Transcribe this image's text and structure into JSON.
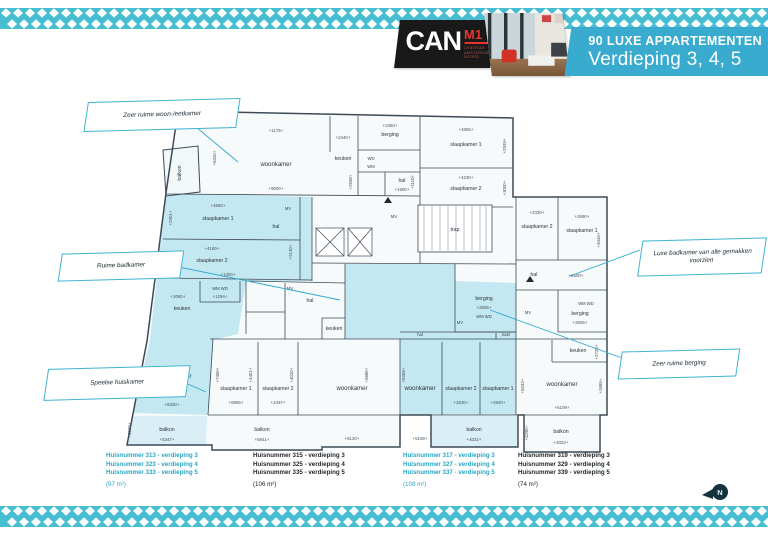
{
  "colors": {
    "teal": "#39abce",
    "pattern": "#47bdd2",
    "logo_red": "#e8352b",
    "plan_blue": "#c3e8f2",
    "balkon_blue": "#daeef6",
    "wall": "#3d4a56"
  },
  "header": {
    "logo": {
      "brand": "CAN",
      "mark": "M1",
      "tagline_lines": [
        "CENTRUM",
        "AMSTERDAM",
        "NOORD"
      ]
    },
    "banner": {
      "title": "90 LUXE APPARTEMENTEN",
      "subtitle": "Verdieping 3, 4, 5"
    }
  },
  "callouts": [
    {
      "text": "Zeer ruime woon-/eetkamer"
    },
    {
      "text": "Ruime badkamer"
    },
    {
      "text": "Speelse huiskamer"
    },
    {
      "text": "Luxe badkamer van alle gemakken voorzien"
    },
    {
      "text": "Zeer ruime berging"
    }
  ],
  "units_legend": [
    {
      "lines": [
        "Huisnummer 313 - verdieping 3",
        "Huisnummer 323 - verdieping 4",
        "Huisnummer 333 - verdieping 5"
      ],
      "area": "(97 m²)",
      "highlight": true
    },
    {
      "lines": [
        "Huisnummer 315 - verdieping 3",
        "Huisnummer 325 - verdieping 4",
        "Huisnummer 335 - verdieping 5"
      ],
      "area": "(106 m²)",
      "highlight": false
    },
    {
      "lines": [
        "Huisnummer 317 - verdieping 3",
        "Huisnummer 327 - verdieping 4",
        "Huisnummer 337 - verdieping 5"
      ],
      "area": "(108 m²)",
      "highlight": true
    },
    {
      "lines": [
        "Huisnummer 319 - verdieping 3",
        "Huisnummer 329 - verdieping 4",
        "Huisnummer 339 - verdieping 5"
      ],
      "area": "(74 m²)",
      "highlight": false
    }
  ],
  "north_badge": {
    "label": "N"
  },
  "floorplan": {
    "labels": [
      {
        "t": "woonkamer",
        "x": 276,
        "y": 166,
        "c": "room"
      },
      {
        "t": "+1175+",
        "x": 276,
        "y": 132,
        "c": "dim"
      },
      {
        "t": "+5320+",
        "x": 216,
        "y": 158,
        "r": -90,
        "c": "dim"
      },
      {
        "t": "+9000+",
        "x": 276,
        "y": 190,
        "c": "dim"
      },
      {
        "t": "keuken",
        "x": 343,
        "y": 160,
        "c": "rsm"
      },
      {
        "t": "+2440+",
        "x": 343,
        "y": 139,
        "c": "dim"
      },
      {
        "t": "berging",
        "x": 390,
        "y": 136,
        "c": "rsm"
      },
      {
        "t": "+2350+",
        "x": 390,
        "y": 127,
        "c": "dim"
      },
      {
        "t": "+2938+",
        "x": 352,
        "y": 182,
        "r": -90,
        "c": "dim"
      },
      {
        "t": "WD",
        "x": 371,
        "y": 160,
        "c": "tiny"
      },
      {
        "t": "WM",
        "x": 371,
        "y": 168,
        "c": "tiny"
      },
      {
        "t": "hal",
        "x": 402,
        "y": 182,
        "c": "rsm"
      },
      {
        "t": "+1900+",
        "x": 402,
        "y": 191,
        "c": "dim"
      },
      {
        "t": "balkon",
        "x": 181,
        "y": 173,
        "r": -90,
        "c": "rsm"
      },
      {
        "t": "slaapkamer 1",
        "x": 466,
        "y": 146,
        "c": "rsm"
      },
      {
        "t": "+4865+",
        "x": 466,
        "y": 131,
        "c": "dim"
      },
      {
        "t": "+2939+",
        "x": 506,
        "y": 146,
        "r": -90,
        "c": "dim"
      },
      {
        "t": "slaapkamer 2",
        "x": 466,
        "y": 190,
        "c": "rsm"
      },
      {
        "t": "+4230+",
        "x": 466,
        "y": 179,
        "c": "dim"
      },
      {
        "t": "+3000+",
        "x": 506,
        "y": 188,
        "r": -90,
        "c": "dim"
      },
      {
        "t": "trap",
        "x": 455,
        "y": 231,
        "c": "rsm"
      },
      {
        "t": "MV",
        "x": 394,
        "y": 218,
        "c": "tiny"
      },
      {
        "t": "+1110+",
        "x": 414,
        "y": 182,
        "r": -90,
        "c": "dim"
      },
      {
        "t": "slaapkamer 2",
        "x": 537,
        "y": 228,
        "c": "rsm"
      },
      {
        "t": "+2330+",
        "x": 537,
        "y": 214,
        "c": "dim"
      },
      {
        "t": "slaapkamer 1",
        "x": 582,
        "y": 232,
        "c": "rsm"
      },
      {
        "t": "+2690+",
        "x": 582,
        "y": 218,
        "c": "dim"
      },
      {
        "t": "+3443+",
        "x": 600,
        "y": 240,
        "r": -90,
        "c": "dim"
      },
      {
        "t": "hal",
        "x": 534,
        "y": 276,
        "c": "rsm"
      },
      {
        "t": "+2500+",
        "x": 576,
        "y": 277,
        "c": "dim"
      },
      {
        "t": "WM WD",
        "x": 586,
        "y": 305,
        "c": "tiny"
      },
      {
        "t": "berging",
        "x": 580,
        "y": 315,
        "c": "rsm"
      },
      {
        "t": "+2505+",
        "x": 580,
        "y": 324,
        "c": "dim"
      },
      {
        "t": "MV",
        "x": 528,
        "y": 314,
        "c": "tiny"
      },
      {
        "t": "keuken",
        "x": 578,
        "y": 352,
        "c": "rsm"
      },
      {
        "t": "+2725+",
        "x": 598,
        "y": 352,
        "r": -90,
        "c": "dim"
      },
      {
        "t": "woonkamer",
        "x": 562,
        "y": 386,
        "c": "room"
      },
      {
        "t": "+5343+",
        "x": 524,
        "y": 386,
        "r": -90,
        "c": "dim"
      },
      {
        "t": "+1885+",
        "x": 602,
        "y": 386,
        "r": -90,
        "c": "dim"
      },
      {
        "t": "+5109+",
        "x": 562,
        "y": 409,
        "c": "dim"
      },
      {
        "t": "balkon",
        "x": 561,
        "y": 433,
        "c": "rsm"
      },
      {
        "t": "+4022+",
        "x": 561,
        "y": 444,
        "c": "dim"
      },
      {
        "t": "+3290+",
        "x": 528,
        "y": 433,
        "r": -90,
        "c": "dim"
      },
      {
        "t": "slaapkamer 1",
        "x": 218,
        "y": 220,
        "c": "rsm"
      },
      {
        "t": "+4660+",
        "x": 218,
        "y": 207,
        "c": "dim"
      },
      {
        "t": "+2901+",
        "x": 172,
        "y": 218,
        "r": -90,
        "c": "dim"
      },
      {
        "t": "slaapkamer 2",
        "x": 212,
        "y": 262,
        "c": "rsm"
      },
      {
        "t": "+4180+",
        "x": 212,
        "y": 250,
        "c": "dim"
      },
      {
        "t": "+2149+",
        "x": 166,
        "y": 260,
        "r": -90,
        "c": "dim"
      },
      {
        "t": "MV",
        "x": 288,
        "y": 210,
        "c": "tiny"
      },
      {
        "t": "hal",
        "x": 276,
        "y": 228,
        "c": "rsm"
      },
      {
        "t": "+2130+",
        "x": 292,
        "y": 252,
        "r": -90,
        "c": "dim"
      },
      {
        "t": "+1300+",
        "x": 228,
        "y": 276,
        "c": "dim"
      },
      {
        "t": "WM WD",
        "x": 220,
        "y": 290,
        "c": "tiny"
      },
      {
        "t": "+1294+",
        "x": 220,
        "y": 298,
        "c": "dim"
      },
      {
        "t": "+2060+",
        "x": 178,
        "y": 298,
        "c": "dim"
      },
      {
        "t": "keuken",
        "x": 182,
        "y": 310,
        "c": "rsm"
      },
      {
        "t": "woonkamer",
        "x": 176,
        "y": 378,
        "c": "room"
      },
      {
        "t": "+7905+",
        "x": 142,
        "y": 378,
        "r": -90,
        "c": "dim"
      },
      {
        "t": "+7450+",
        "x": 219,
        "y": 375,
        "r": -90,
        "c": "dim"
      },
      {
        "t": "+8330+",
        "x": 172,
        "y": 406,
        "c": "dim"
      },
      {
        "t": "balkon",
        "x": 167,
        "y": 431,
        "c": "rsm"
      },
      {
        "t": "+5347+",
        "x": 167,
        "y": 441,
        "c": "dim"
      },
      {
        "t": "+2320+",
        "x": 131,
        "y": 430,
        "r": -90,
        "c": "dim"
      },
      {
        "t": "hal",
        "x": 310,
        "y": 302,
        "c": "rsm"
      },
      {
        "t": "MV",
        "x": 290,
        "y": 290,
        "c": "tiny"
      },
      {
        "t": "keuken",
        "x": 334,
        "y": 330,
        "c": "rsm"
      },
      {
        "t": "slaapkamer 1",
        "x": 236,
        "y": 390,
        "c": "rsm"
      },
      {
        "t": "+6955+",
        "x": 236,
        "y": 404,
        "c": "dim"
      },
      {
        "t": "+4401+",
        "x": 252,
        "y": 375,
        "r": -90,
        "c": "dim"
      },
      {
        "t": "slaapkamer 2",
        "x": 278,
        "y": 390,
        "c": "rsm"
      },
      {
        "t": "+2437+",
        "x": 278,
        "y": 404,
        "c": "dim"
      },
      {
        "t": "+4020+",
        "x": 293,
        "y": 375,
        "r": -90,
        "c": "dim"
      },
      {
        "t": "woonkamer",
        "x": 352,
        "y": 390,
        "c": "room"
      },
      {
        "t": "+5120+",
        "x": 352,
        "y": 440,
        "c": "dim"
      },
      {
        "t": "+6880+",
        "x": 368,
        "y": 375,
        "r": -90,
        "c": "dim"
      },
      {
        "t": "balkon",
        "x": 262,
        "y": 431,
        "c": "rsm"
      },
      {
        "t": "+5941+",
        "x": 262,
        "y": 441,
        "c": "dim"
      },
      {
        "t": "hal",
        "x": 420,
        "y": 336,
        "c": "tiny"
      },
      {
        "t": "kast",
        "x": 506,
        "y": 336,
        "c": "tiny"
      },
      {
        "t": "berging",
        "x": 484,
        "y": 300,
        "c": "rsm"
      },
      {
        "t": "+2505+",
        "x": 484,
        "y": 309,
        "c": "dim"
      },
      {
        "t": "WM WD",
        "x": 484,
        "y": 318,
        "c": "tiny"
      },
      {
        "t": "MV",
        "x": 460,
        "y": 324,
        "c": "tiny"
      },
      {
        "t": "woonkamer",
        "x": 420,
        "y": 390,
        "c": "room"
      },
      {
        "t": "+5108+",
        "x": 420,
        "y": 440,
        "c": "dim"
      },
      {
        "t": "+5365+",
        "x": 405,
        "y": 375,
        "r": -90,
        "c": "dim"
      },
      {
        "t": "slaapkamer 2",
        "x": 461,
        "y": 390,
        "c": "rsm"
      },
      {
        "t": "+3230+",
        "x": 461,
        "y": 404,
        "c": "dim"
      },
      {
        "t": "slaapkamer 1",
        "x": 498,
        "y": 390,
        "c": "rsm"
      },
      {
        "t": "+2940+",
        "x": 498,
        "y": 404,
        "c": "dim"
      },
      {
        "t": "balkon",
        "x": 474,
        "y": 431,
        "c": "rsm"
      },
      {
        "t": "+4022+",
        "x": 474,
        "y": 441,
        "c": "dim"
      }
    ]
  }
}
